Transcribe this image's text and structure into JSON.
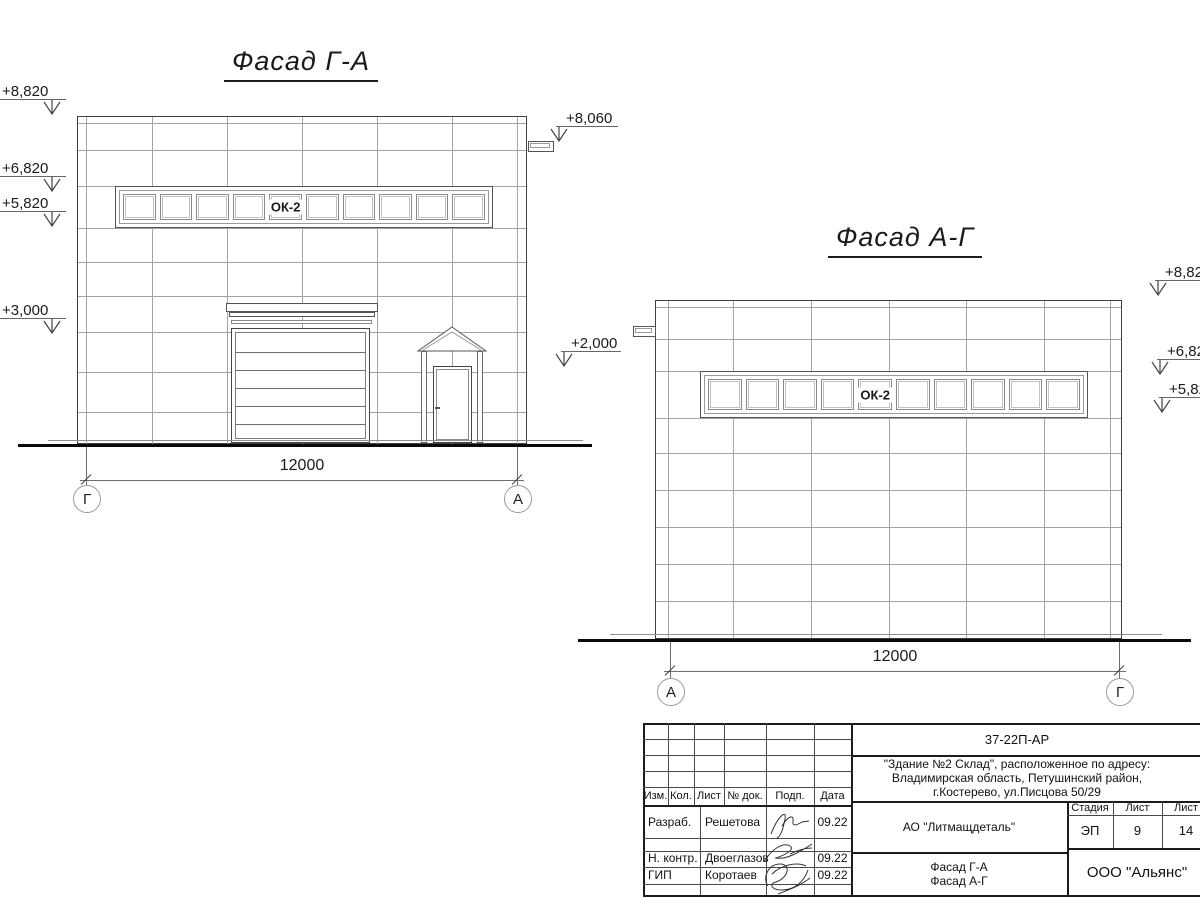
{
  "drawing": {
    "facade_ga": {
      "title": "Фасад Г-А",
      "window_label": "ОК-2",
      "dim_text": "12000",
      "axis_left": "Г",
      "axis_right": "А",
      "elev_8820": "+8,820",
      "elev_6820": "+6,820",
      "elev_5820": "+5,820",
      "elev_3000": "+3,000",
      "elev_8060": "+8,060",
      "elev_2000": "+2,000"
    },
    "facade_ag": {
      "title": "Фасад А-Г",
      "window_label": "ОК-2",
      "dim_text": "12000",
      "axis_left": "А",
      "axis_right": "Г",
      "elev_882": "+8,82",
      "elev_682": "+6,82",
      "elev_582": "+5,82"
    },
    "titleblock": {
      "doc_number": "37-22П-АР",
      "object_line1": "\"Здание №2 Склад\", расположенное по адресу:",
      "object_line2": "Владимирская область, Петушинский район,",
      "object_line3": "г.Костерево, ул.Писцова 50/29",
      "col_izm": "Изм.",
      "col_kol": "Кол.",
      "col_list": "Лист",
      "col_ndok": "№ док.",
      "col_podp": "Подп.",
      "col_data": "Дата",
      "row1_role": "Разраб.",
      "row1_name": "Решетова",
      "row1_date": "09.22",
      "row2_role": "Н. контр.",
      "row2_name": "Двоеглазов",
      "row2_date": "09.22",
      "row3_role": "ГИП",
      "row3_name": "Коротаев",
      "row3_date": "09.22",
      "client": "АО \"Литмащдеталь\"",
      "stage_label": "Стадия",
      "stage_value": "ЭП",
      "sheet_label": "Лист",
      "sheet_value": "9",
      "sheets_label": "Лист",
      "sheets_value": "14",
      "content_line1": "Фасад Г-А",
      "content_line2": "Фасад А-Г",
      "org": "ООО \"Альянс\""
    }
  }
}
